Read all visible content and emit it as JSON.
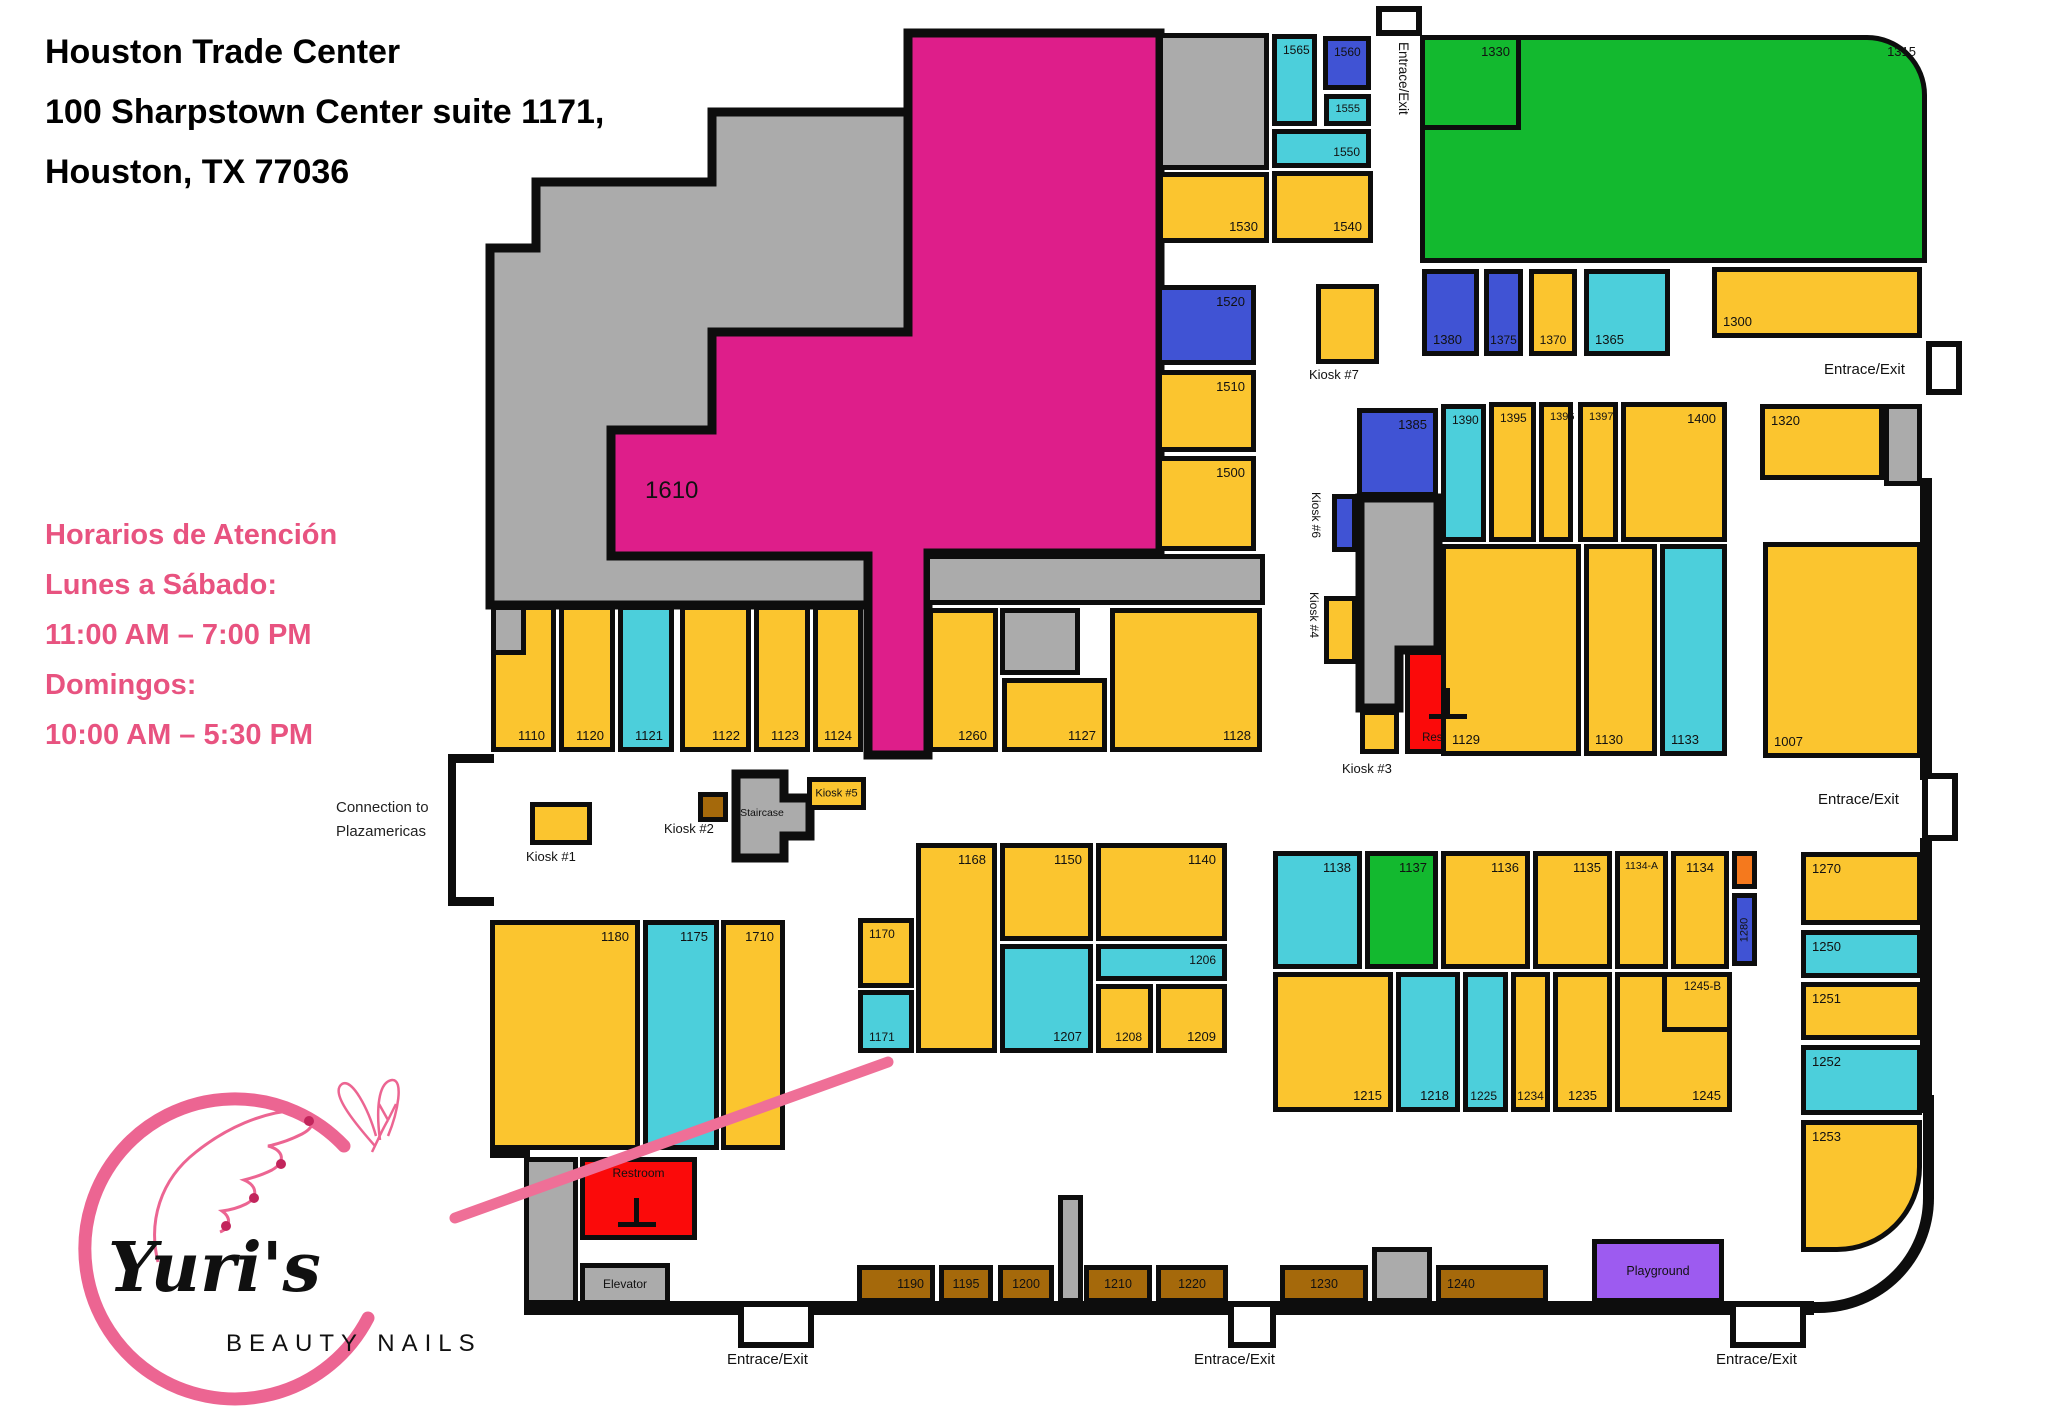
{
  "header": {
    "line1": "Houston Trade Center",
    "line2": "100 Sharpstown Center suite 1171,",
    "line3": " Houston, TX 77036"
  },
  "hours": {
    "title": "Horarios de Atención",
    "lines": [
      "Lunes a Sábado:",
      "11:00 AM – 7:00 PM",
      "Domingos:",
      "10:00 AM – 5:30 PM"
    ],
    "text_color": "#E85380"
  },
  "connection": {
    "line1": "Connection to",
    "line2": "Plazamericas"
  },
  "logo": {
    "name": "Yuri's",
    "subtitle": "BEAUTY NAILS",
    "accent_color": "#EC6592"
  },
  "colors": {
    "y": "#FBC52F",
    "t": "#4CCFDB",
    "b": "#4053D4",
    "g": "#13B92F",
    "m": "#DE1E8A",
    "gray": "#ABABAB",
    "r": "#FB0A0A",
    "n": "#A5690B",
    "p": "#9D5BF0",
    "o": "#F5791D",
    "wall": "#0d0d0d",
    "line": "#EF6F97"
  },
  "big_store_label": "1610",
  "rooms": [
    {
      "id": "gray-top-block",
      "x": 1158,
      "y": 33,
      "w": 111,
      "h": 137,
      "c": "gray"
    },
    {
      "n": "1565",
      "x": 1272,
      "y": 34,
      "w": 45,
      "h": 92,
      "c": "t",
      "p": "tl",
      "s": 12
    },
    {
      "n": "1560",
      "x": 1323,
      "y": 36,
      "w": 48,
      "h": 54,
      "c": "b",
      "p": "tl",
      "s": 12
    },
    {
      "n": "1555",
      "x": 1324,
      "y": 94,
      "w": 47,
      "h": 32,
      "c": "t",
      "p": "tr",
      "s": 11
    },
    {
      "n": "1550",
      "x": 1272,
      "y": 129,
      "w": 99,
      "h": 39,
      "c": "t",
      "p": "br",
      "s": 12
    },
    {
      "n": "1530",
      "x": 1158,
      "y": 172,
      "w": 111,
      "h": 71,
      "c": "y",
      "p": "br"
    },
    {
      "n": "1540",
      "x": 1272,
      "y": 171,
      "w": 101,
      "h": 72,
      "c": "y",
      "p": "br"
    },
    {
      "n": "1520",
      "x": 1157,
      "y": 285,
      "w": 99,
      "h": 80,
      "c": "b",
      "p": "tr"
    },
    {
      "n": "1510",
      "x": 1157,
      "y": 370,
      "w": 99,
      "h": 82,
      "c": "y",
      "p": "tr"
    },
    {
      "n": "1500",
      "x": 1157,
      "y": 456,
      "w": 99,
      "h": 95,
      "c": "y",
      "p": "tr"
    },
    {
      "n": "1315",
      "x": 1420,
      "y": 35,
      "w": 507,
      "h": 228,
      "c": "g",
      "p": "tr",
      "rtr": 1
    },
    {
      "n": "1330",
      "x": 1420,
      "y": 35,
      "w": 101,
      "h": 95,
      "c": "g",
      "p": "tr"
    },
    {
      "n": "1380",
      "x": 1422,
      "y": 269,
      "w": 57,
      "h": 87,
      "c": "b",
      "p": "bl"
    },
    {
      "n": "1375",
      "x": 1484,
      "y": 269,
      "w": 39,
      "h": 87,
      "c": "b",
      "p": "bc",
      "s": 12
    },
    {
      "n": "1370",
      "x": 1529,
      "y": 269,
      "w": 48,
      "h": 87,
      "c": "y",
      "p": "bc",
      "s": 12
    },
    {
      "n": "1365",
      "x": 1584,
      "y": 269,
      "w": 86,
      "h": 87,
      "c": "t",
      "p": "bl"
    },
    {
      "n": "1300",
      "x": 1712,
      "y": 267,
      "w": 210,
      "h": 71,
      "c": "y",
      "p": "bl"
    },
    {
      "id": "kiosk-7-box",
      "x": 1316,
      "y": 284,
      "w": 63,
      "h": 80,
      "c": "y"
    },
    {
      "n": "1385",
      "x": 1357,
      "y": 408,
      "w": 81,
      "h": 89,
      "c": "b",
      "p": "tr"
    },
    {
      "n": "1390",
      "x": 1441,
      "y": 404,
      "w": 45,
      "h": 138,
      "c": "t",
      "p": "tl",
      "s": 12
    },
    {
      "n": "1395",
      "x": 1489,
      "y": 402,
      "w": 47,
      "h": 140,
      "c": "y",
      "p": "tl",
      "s": 12
    },
    {
      "n": "1396",
      "x": 1539,
      "y": 402,
      "w": 34,
      "h": 140,
      "c": "y",
      "p": "tl",
      "s": 11
    },
    {
      "n": "1397",
      "x": 1578,
      "y": 402,
      "w": 40,
      "h": 140,
      "c": "y",
      "p": "tl",
      "s": 11
    },
    {
      "n": "1400",
      "x": 1621,
      "y": 402,
      "w": 106,
      "h": 140,
      "c": "y",
      "p": "tr"
    },
    {
      "n": "1320",
      "x": 1760,
      "y": 404,
      "w": 124,
      "h": 76,
      "c": "y",
      "p": "tl"
    },
    {
      "id": "gray-strip-right",
      "x": 1884,
      "y": 404,
      "w": 38,
      "h": 82,
      "c": "gray"
    },
    {
      "id": "kiosk-6-box",
      "x": 1332,
      "y": 494,
      "w": 25,
      "h": 58,
      "c": "b"
    },
    {
      "id": "kiosk-4-box",
      "x": 1324,
      "y": 596,
      "w": 33,
      "h": 68,
      "c": "y"
    },
    {
      "n": "Restroom",
      "id": "restroom-upper",
      "x": 1405,
      "y": 650,
      "w": 84,
      "h": 104,
      "c": "r",
      "p": "bc",
      "s": 11.5
    },
    {
      "id": "kiosk-3-box",
      "x": 1360,
      "y": 710,
      "w": 39,
      "h": 44,
      "c": "y"
    },
    {
      "n": "1129",
      "x": 1441,
      "y": 544,
      "w": 140,
      "h": 212,
      "c": "y",
      "p": "bl"
    },
    {
      "n": "1130",
      "x": 1584,
      "y": 544,
      "w": 73,
      "h": 212,
      "c": "y",
      "p": "bl"
    },
    {
      "n": "1133",
      "x": 1660,
      "y": 544,
      "w": 67,
      "h": 212,
      "c": "t",
      "p": "bl"
    },
    {
      "n": "1007",
      "x": 1763,
      "y": 542,
      "w": 159,
      "h": 216,
      "c": "y",
      "p": "bl"
    },
    {
      "n": "1110",
      "x": 491,
      "y": 605,
      "w": 65,
      "h": 147,
      "c": "y",
      "p": "br"
    },
    {
      "id": "stores-gray-notch",
      "x": 491,
      "y": 605,
      "w": 35,
      "h": 50,
      "c": "gray"
    },
    {
      "n": "1120",
      "x": 559,
      "y": 605,
      "w": 56,
      "h": 147,
      "c": "y",
      "p": "br"
    },
    {
      "n": "1121",
      "x": 618,
      "y": 605,
      "w": 56,
      "h": 147,
      "c": "t",
      "p": "br"
    },
    {
      "n": "1122",
      "x": 680,
      "y": 605,
      "w": 71,
      "h": 147,
      "c": "y",
      "p": "br"
    },
    {
      "n": "1123",
      "x": 754,
      "y": 605,
      "w": 56,
      "h": 147,
      "c": "y",
      "p": "br"
    },
    {
      "n": "1124",
      "x": 813,
      "y": 605,
      "w": 50,
      "h": 147,
      "c": "y",
      "p": "br"
    },
    {
      "id": "gray-strip-mid",
      "x": 925,
      "y": 554,
      "w": 340,
      "h": 51,
      "c": "gray"
    },
    {
      "n": "1260",
      "x": 928,
      "y": 608,
      "w": 70,
      "h": 144,
      "c": "y",
      "p": "br"
    },
    {
      "id": "gray-sq-1127",
      "x": 1000,
      "y": 608,
      "w": 80,
      "h": 67,
      "c": "gray"
    },
    {
      "n": "1127",
      "x": 1002,
      "y": 678,
      "w": 105,
      "h": 74,
      "c": "y",
      "p": "br"
    },
    {
      "n": "1128",
      "x": 1110,
      "y": 608,
      "w": 152,
      "h": 144,
      "c": "y",
      "p": "br"
    },
    {
      "id": "kiosk-1-box",
      "x": 530,
      "y": 802,
      "w": 62,
      "h": 43,
      "c": "y"
    },
    {
      "id": "kiosk-2-box",
      "x": 698,
      "y": 792,
      "w": 30,
      "h": 30,
      "c": "n"
    },
    {
      "n": "Kiosk #5",
      "id": "kiosk-5-box",
      "x": 807,
      "y": 777,
      "w": 59,
      "h": 33,
      "c": "y",
      "p": "c",
      "s": 11
    },
    {
      "n": "1170",
      "x": 858,
      "y": 918,
      "w": 56,
      "h": 70,
      "c": "y",
      "p": "tl",
      "s": 12
    },
    {
      "n": "1171",
      "x": 858,
      "y": 990,
      "w": 56,
      "h": 63,
      "c": "t",
      "p": "bl",
      "s": 12
    },
    {
      "n": "1168",
      "x": 916,
      "y": 843,
      "w": 81,
      "h": 210,
      "c": "y",
      "p": "tr"
    },
    {
      "n": "1150",
      "x": 1000,
      "y": 843,
      "w": 93,
      "h": 98,
      "c": "y",
      "p": "tr"
    },
    {
      "n": "1140",
      "x": 1096,
      "y": 843,
      "w": 131,
      "h": 98,
      "c": "y",
      "p": "tr"
    },
    {
      "n": "1207",
      "x": 1000,
      "y": 944,
      "w": 93,
      "h": 109,
      "c": "t",
      "p": "br"
    },
    {
      "n": "1206",
      "x": 1096,
      "y": 944,
      "w": 131,
      "h": 37,
      "c": "t",
      "p": "tr",
      "s": 12
    },
    {
      "n": "1208",
      "x": 1096,
      "y": 984,
      "w": 57,
      "h": 69,
      "c": "y",
      "p": "br",
      "s": 12
    },
    {
      "n": "1209",
      "x": 1156,
      "y": 984,
      "w": 71,
      "h": 69,
      "c": "y",
      "p": "br"
    },
    {
      "n": "1138",
      "x": 1273,
      "y": 851,
      "w": 89,
      "h": 118,
      "c": "t",
      "p": "tr"
    },
    {
      "n": "1137",
      "x": 1365,
      "y": 851,
      "w": 73,
      "h": 118,
      "c": "g",
      "p": "tr"
    },
    {
      "n": "1136",
      "x": 1441,
      "y": 851,
      "w": 89,
      "h": 118,
      "c": "y",
      "p": "tr"
    },
    {
      "n": "1135",
      "x": 1533,
      "y": 851,
      "w": 79,
      "h": 118,
      "c": "y",
      "p": "tr"
    },
    {
      "n": "1134-A",
      "x": 1615,
      "y": 851,
      "w": 53,
      "h": 118,
      "c": "y",
      "p": "tc",
      "s": 10.5
    },
    {
      "n": "1134",
      "x": 1671,
      "y": 851,
      "w": 58,
      "h": 118,
      "c": "y",
      "p": "tc"
    },
    {
      "id": "orange-box",
      "x": 1732,
      "y": 851,
      "w": 25,
      "h": 38,
      "c": "o"
    },
    {
      "n": "1280",
      "id": "room-1280",
      "x": 1732,
      "y": 893,
      "w": 25,
      "h": 73,
      "c": "b",
      "p": "rot",
      "s": 11
    },
    {
      "n": "1215",
      "x": 1273,
      "y": 972,
      "w": 120,
      "h": 140,
      "c": "y",
      "p": "br"
    },
    {
      "n": "1218",
      "x": 1396,
      "y": 972,
      "w": 64,
      "h": 140,
      "c": "t",
      "p": "br"
    },
    {
      "n": "1225",
      "x": 1463,
      "y": 972,
      "w": 45,
      "h": 140,
      "c": "t",
      "p": "br",
      "s": 12
    },
    {
      "n": "1234",
      "x": 1511,
      "y": 972,
      "w": 39,
      "h": 140,
      "c": "y",
      "p": "bc",
      "s": 12
    },
    {
      "n": "1235",
      "x": 1553,
      "y": 972,
      "w": 59,
      "h": 140,
      "c": "y",
      "p": "bc"
    },
    {
      "n": "1245",
      "x": 1615,
      "y": 972,
      "w": 117,
      "h": 140,
      "c": "y",
      "p": "br"
    },
    {
      "n": "1245-B",
      "x": 1662,
      "y": 972,
      "w": 70,
      "h": 60,
      "c": "y",
      "p": "tr",
      "s": 11.5
    },
    {
      "n": "1270",
      "x": 1801,
      "y": 852,
      "w": 121,
      "h": 73,
      "c": "y",
      "p": "tl"
    },
    {
      "n": "1250",
      "x": 1801,
      "y": 930,
      "w": 121,
      "h": 48,
      "c": "t",
      "p": "tl"
    },
    {
      "n": "1251",
      "x": 1801,
      "y": 982,
      "w": 121,
      "h": 58,
      "c": "y",
      "p": "tl"
    },
    {
      "n": "1252",
      "x": 1801,
      "y": 1045,
      "w": 121,
      "h": 70,
      "c": "t",
      "p": "tl"
    },
    {
      "n": "1253",
      "x": 1801,
      "y": 1120,
      "w": 121,
      "h": 132,
      "c": "y",
      "p": "tl",
      "rbr": 1
    },
    {
      "n": "1180",
      "x": 490,
      "y": 920,
      "w": 150,
      "h": 230,
      "c": "y",
      "p": "tr"
    },
    {
      "n": "1175",
      "x": 643,
      "y": 920,
      "w": 76,
      "h": 230,
      "c": "t",
      "p": "tr"
    },
    {
      "n": "1710",
      "x": 721,
      "y": 920,
      "w": 64,
      "h": 230,
      "c": "y",
      "p": "tr"
    },
    {
      "id": "gray-col-bottom",
      "x": 524,
      "y": 1157,
      "w": 54,
      "h": 148,
      "c": "gray"
    },
    {
      "n": "Restroom",
      "id": "restroom-lower",
      "x": 580,
      "y": 1157,
      "w": 117,
      "h": 83,
      "c": "r",
      "p": "tc",
      "s": 12
    },
    {
      "n": "Elevator",
      "id": "elevator",
      "x": 580,
      "y": 1263,
      "w": 90,
      "h": 42,
      "c": "gray",
      "p": "c",
      "s": 12
    },
    {
      "n": "1190",
      "x": 857,
      "y": 1265,
      "w": 78,
      "h": 38,
      "c": "n",
      "p": "cr",
      "s": 12.5
    },
    {
      "n": "1195",
      "x": 939,
      "y": 1265,
      "w": 54,
      "h": 38,
      "c": "n",
      "p": "c",
      "s": 12.5
    },
    {
      "n": "1200",
      "x": 998,
      "y": 1265,
      "w": 56,
      "h": 38,
      "c": "n",
      "p": "c",
      "s": 12.5
    },
    {
      "id": "gray-col-1058",
      "x": 1058,
      "y": 1195,
      "w": 25,
      "h": 108,
      "c": "gray"
    },
    {
      "n": "1210",
      "x": 1084,
      "y": 1265,
      "w": 68,
      "h": 38,
      "c": "n",
      "p": "c",
      "s": 12.5
    },
    {
      "n": "1220",
      "x": 1156,
      "y": 1265,
      "w": 72,
      "h": 38,
      "c": "n",
      "p": "c",
      "s": 12.5
    },
    {
      "n": "1230",
      "x": 1280,
      "y": 1265,
      "w": 88,
      "h": 38,
      "c": "n",
      "p": "c",
      "s": 12.5
    },
    {
      "id": "gray-box-1372",
      "x": 1372,
      "y": 1247,
      "w": 60,
      "h": 56,
      "c": "gray"
    },
    {
      "n": "1240",
      "x": 1436,
      "y": 1265,
      "w": 112,
      "h": 38,
      "c": "n",
      "p": "cl",
      "s": 12.5
    },
    {
      "n": "Playground",
      "id": "playground",
      "x": 1592,
      "y": 1239,
      "w": 132,
      "h": 64,
      "c": "p",
      "p": "c",
      "s": 12.5
    }
  ],
  "annotations": [
    {
      "t": "1610",
      "x": 645,
      "y": 478,
      "s": 24,
      "name": "label-1610"
    },
    {
      "t": "Kiosk #7",
      "x": 1309,
      "y": 368,
      "s": 13,
      "name": "label-kiosk-7"
    },
    {
      "t": "Kiosk #1",
      "x": 526,
      "y": 850,
      "s": 13,
      "name": "label-kiosk-1"
    },
    {
      "t": "Kiosk #2",
      "x": 664,
      "y": 822,
      "s": 13,
      "name": "label-kiosk-2"
    },
    {
      "t": "Kiosk #3",
      "x": 1342,
      "y": 762,
      "s": 13,
      "name": "label-kiosk-3"
    },
    {
      "t": "Staircase",
      "x": 712,
      "y": 808,
      "s": 10.5,
      "w": 100,
      "a": "center",
      "name": "label-staircase"
    },
    {
      "t": "Kiosk #6",
      "x": 1322,
      "y": 492,
      "s": 12,
      "r": 90,
      "name": "label-kiosk-6"
    },
    {
      "t": "Kiosk #4",
      "x": 1320,
      "y": 592,
      "s": 12,
      "r": 90,
      "name": "label-kiosk-4"
    },
    {
      "t": "Entrace/Exit",
      "x": 1410,
      "y": 42,
      "s": 13.5,
      "r": 90,
      "name": "entrance-label-top"
    },
    {
      "t": "Entrace/Exit",
      "x": 1824,
      "y": 362,
      "s": 15,
      "name": "entrance-label-right-upper"
    },
    {
      "t": "Entrace/Exit",
      "x": 1818,
      "y": 792,
      "s": 15,
      "name": "entrance-label-right-mid"
    },
    {
      "t": "Entrace/Exit",
      "x": 727,
      "y": 1352,
      "s": 15,
      "name": "entrance-label-bottom-left"
    },
    {
      "t": "Entrace/Exit",
      "x": 1194,
      "y": 1352,
      "s": 15,
      "name": "entrance-label-bottom-mid"
    },
    {
      "t": "Entrace/Exit",
      "x": 1716,
      "y": 1352,
      "s": 15,
      "name": "entrance-label-bottom-right"
    }
  ],
  "doors": [
    {
      "x": 1376,
      "y": 6,
      "w": 46,
      "h": 30,
      "name": "door-top"
    },
    {
      "x": 1926,
      "y": 341,
      "w": 36,
      "h": 54,
      "name": "door-right-upper"
    },
    {
      "x": 1922,
      "y": 773,
      "w": 36,
      "h": 68,
      "name": "door-right-mid"
    },
    {
      "x": 738,
      "y": 1301,
      "w": 76,
      "h": 47,
      "name": "door-bottom-left"
    },
    {
      "x": 1228,
      "y": 1301,
      "w": 48,
      "h": 47,
      "name": "door-bottom-mid"
    },
    {
      "x": 1730,
      "y": 1301,
      "w": 76,
      "h": 47,
      "name": "door-bottom-right"
    }
  ],
  "walls": [
    {
      "x": 524,
      "y": 1301,
      "w": 1290,
      "h": 14
    },
    {
      "x": 1920,
      "y": 478,
      "w": 12,
      "h": 302
    },
    {
      "x": 1920,
      "y": 838,
      "w": 12,
      "h": 275
    },
    {
      "x": 490,
      "y": 1146,
      "w": 40,
      "h": 12
    },
    {
      "x": 448,
      "y": 754,
      "w": 46,
      "h": 9
    },
    {
      "x": 448,
      "y": 897,
      "w": 46,
      "h": 9
    },
    {
      "x": 448,
      "y": 754,
      "w": 8,
      "h": 152
    },
    {
      "x": 1445,
      "y": 688,
      "w": 5,
      "h": 30
    },
    {
      "x": 1429,
      "y": 714,
      "w": 38,
      "h": 5
    },
    {
      "x": 634,
      "y": 1198,
      "w": 5,
      "h": 28
    },
    {
      "x": 618,
      "y": 1222,
      "w": 38,
      "h": 5
    }
  ],
  "curve_wall": {
    "x": 1806,
    "y": 1095,
    "w": 128,
    "h": 218
  },
  "polygons": {
    "gray_region": "712,112 908,112 908,335 715,335 715,435 611,435 611,556 868,556 868,605 490,605 490,248 536,248 536,182 712,182",
    "magenta_region_1610": "908,33 1160,33 1160,553 928,553 928,755 868,755 868,556 611,556 611,430 712,430 712,332 908,332",
    "gray_column_mid": "1360,498 1438,498 1438,650 1399,650 1399,708 1360,708",
    "staircase_shape": "736,774 784,774 784,798 810,798 810,836 784,836 784,858 736,858"
  },
  "pink_line": {
    "x1": 455,
    "y1": 1218,
    "x2": 888,
    "y2": 1062
  }
}
